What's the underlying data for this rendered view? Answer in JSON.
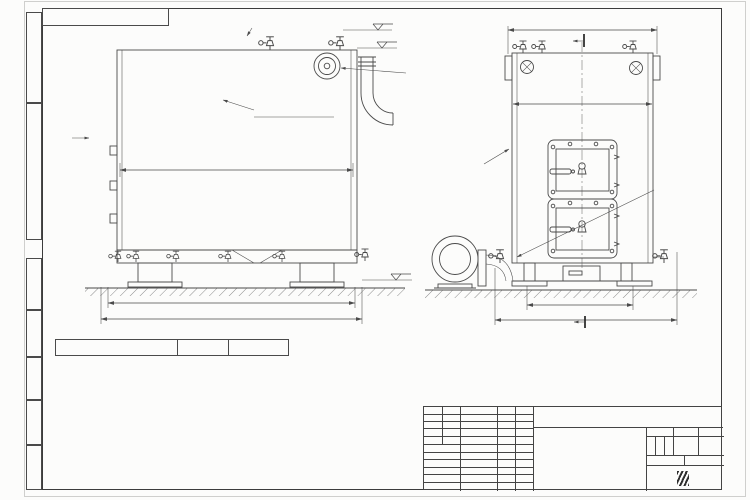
{
  "sheet": {
    "stamp_top": "КВТД.054.101.00.000 ВО",
    "watermark": "KVZR.RU",
    "format_label": "Формат А3"
  },
  "margin_labels": [
    "Перв. примен.",
    "Справ. №",
    "Подп. и дата",
    "Инв. № дубл.",
    "Взам. инв. №",
    "Подп. и дата",
    "Инв. № подл."
  ],
  "drawing": {
    "view_labels": {
      "b": "В",
      "a_side": "А",
      "a_front": "А",
      "b_section": "Б"
    },
    "callout": "см. п. 1",
    "levels": {
      "top1": "+2.217",
      "top2": "+2.100",
      "ground": "0.000"
    },
    "labels": {
      "inlet_side": {
        "line1": "Вход воды",
        "line2": "Dy100"
      },
      "outlet": {
        "line1": "Выход воды",
        "line2": "Dy100"
      },
      "inlet_front": {
        "line1": "Вход воды",
        "line2": "Dy100"
      }
    },
    "dims": {
      "side_inner": "2115",
      "side_base": "2245",
      "side_total": "2370",
      "front_top": "1360",
      "front_inner": "1260",
      "front_base": "960",
      "front_total": "1590"
    }
  },
  "spec_table": {
    "title": "Техническая характеристика",
    "headers": [
      "Наименование показателя",
      "Единицы измерения",
      "Значение"
    ],
    "rows": [
      [
        "Номинальная мощность",
        "МВт",
        "0,63"
      ],
      [
        "Диапазон рабочего регулирования",
        "%",
        "40-110"
      ],
      [
        "Расход воды",
        "м3/ч",
        "22"
      ],
      [
        "Рабочее давление воды",
        "МПа (кгс/см2)",
        "0,6 (6,0)"
      ],
      [
        "Гидравлическое сопротивление котла",
        "МПа (кгс/см2)",
        "0,06 (0,6)"
      ],
      [
        "Температура уходящих газов",
        "°С",
        "не более 280"
      ],
      [
        "Температура воды (вход/выход)",
        "°С",
        "70/95"
      ],
      [
        "Габариты котла",
        "",
        ""
      ],
      [
        "- длина",
        "мм",
        "2370"
      ],
      [
        "- ширина",
        "мм",
        "1605"
      ],
      [
        "- высота",
        "мм",
        "2150"
      ]
    ]
  },
  "notes": [
    "1. На боковой стенке котла в области топочной камеры установлен пробоотборный штуцер",
    "2. Температура воды на входе 70°С, на выходе 95°С.",
    "3. На подводящей трубе котла, до запорной арматуры установлены: манометр, прибор для измерения температуры.",
    "4. На отводящей трубе котла, до запорной арматуры установлены: манометр, прибор для измерения температуры и два предохранительных клапана Dу не менее 40 мм.",
    "5. Остальные технические требования по ОСТ 108.030.133-84."
  ],
  "title_block": {
    "designation": "КВТД.054.101.00.000 ВО",
    "doc_title_lines": [
      "Котел водогрейный",
      "КВ-0,63 Д (РВР)",
      "по техническому заданию"
    ],
    "header_cols": [
      "Изм.",
      "Лист",
      "N докум.",
      "Подп.",
      "Дата"
    ],
    "row_labels": [
      "Разраб.",
      "Пров.",
      "Т.контр.",
      "",
      "Н.контр.",
      "Утв."
    ],
    "lit_label": "Лит.",
    "lit_value": "И",
    "mass_label": "Масса",
    "scale_label": "Масштаб",
    "scale_value": "1:15",
    "sheet_label": "Лист",
    "sheet_value": "1",
    "sheets_label": "Листов",
    "sheets_value": "2",
    "company": {
      "logo_text": "KVZR",
      "name_line1": "КОТЕЛЬНЫЙ",
      "name_line2": "ЗАВОД РЭП"
    }
  }
}
